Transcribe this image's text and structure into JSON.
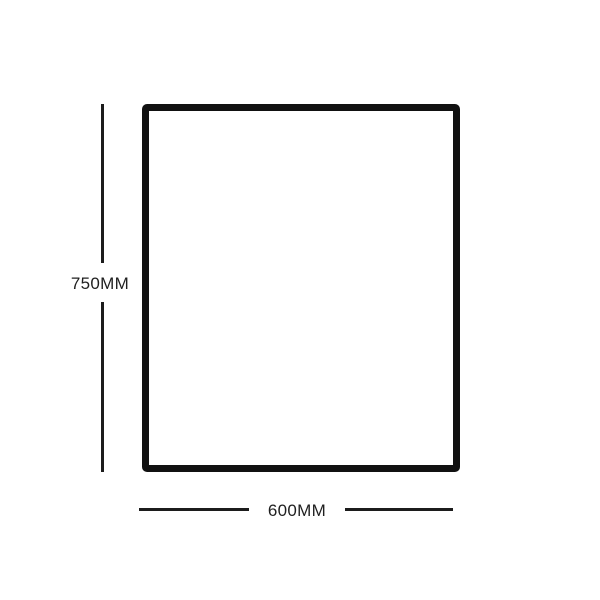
{
  "diagram": {
    "height_dimension": {
      "label": "750MM",
      "value_mm": 750
    },
    "width_dimension": {
      "label": "600MM",
      "value_mm": 600
    },
    "colors": {
      "outline": "#111111",
      "dimension_line": "#1c1c1c",
      "label_text": "#1f1f1f",
      "background": "#ffffff"
    }
  }
}
